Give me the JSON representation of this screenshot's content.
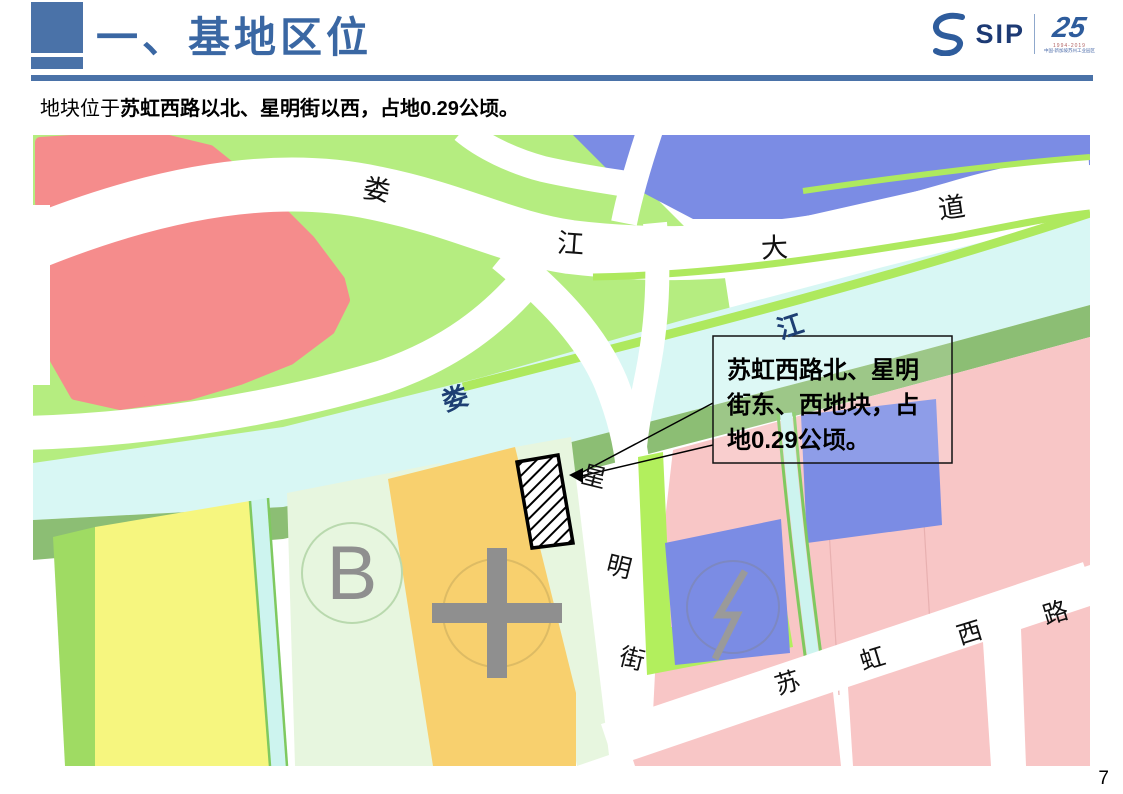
{
  "header": {
    "title": "一、基地区位",
    "logo": {
      "brand": "SIP",
      "anniversary": "25",
      "caption_years": "1994-2019",
      "caption_text": "中国-新加坡苏州工业园区"
    },
    "accent_color": "#4a72a8"
  },
  "subtitle": {
    "prefix": "地块位于",
    "emphasis": "苏虹西路以北、星明街以西，占地0.29公顷。"
  },
  "map": {
    "callout": {
      "line1": "苏虹西路北、星明",
      "line2": "街东、西地块，占",
      "line3": "地0.29公顷。"
    },
    "labels": {
      "avenue": {
        "c1": "娄",
        "c2": "江",
        "c3": "大",
        "c4": "道"
      },
      "river": {
        "c1": "娄",
        "c2": "江"
      },
      "street": {
        "c1": "星",
        "c2": "明",
        "c3": "街"
      },
      "road": {
        "c1": "苏",
        "c2": "虹",
        "c3": "西",
        "c4": "路"
      },
      "parcel_b": "B"
    },
    "colors": {
      "green": "#b5ed80",
      "salmon": "#f58c8c",
      "blue": "#7b8ce4",
      "river": "#d8f7f4",
      "bank": "#8cbe74",
      "strip": "#aee95e",
      "yellow": "#f6f67f",
      "mint": "#e7f6df",
      "orange": "#f8d06e",
      "pink": "#f8c6c6",
      "symbol_gray": "#8f8f8f",
      "river_label": "#1d3f73"
    }
  },
  "footer": {
    "page_number": "7"
  }
}
